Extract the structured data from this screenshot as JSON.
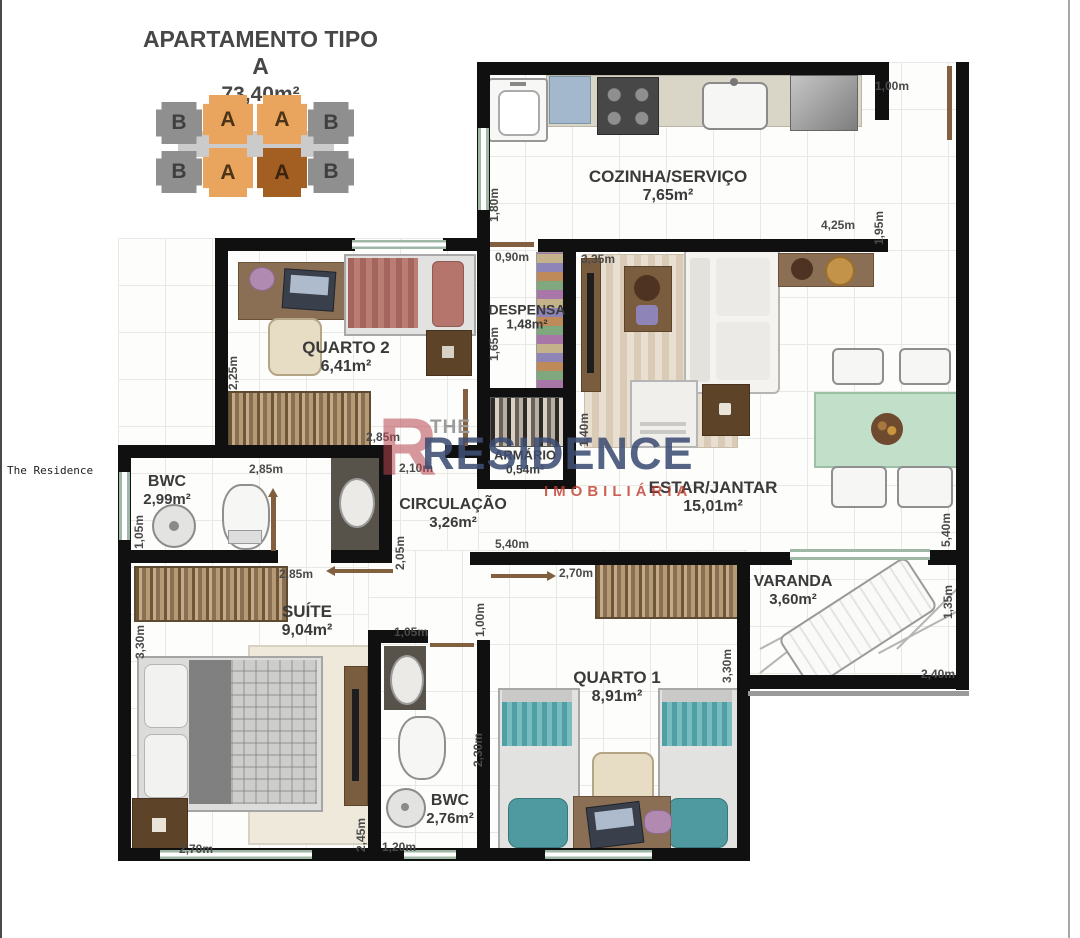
{
  "header": {
    "title": "APARTAMENTO TIPO A",
    "area": "73,40m²"
  },
  "side_text": "The Residence",
  "watermark": {
    "the": "THE",
    "big_letter": "R",
    "main": "RESIDENCE",
    "sub": "IMOBILIÁRIA"
  },
  "key_plan": {
    "units": [
      {
        "label": "B"
      },
      {
        "label": "A"
      },
      {
        "label": "A"
      },
      {
        "label": "B"
      },
      {
        "label": "B"
      },
      {
        "label": "A"
      },
      {
        "label": "A",
        "highlighted": true
      },
      {
        "label": "B"
      }
    ],
    "highlighted_index": 6
  },
  "colors": {
    "wall": "#101010",
    "window": "#9fb7a5",
    "unit_a": "#e9a55e",
    "unit_a_highlighted": "#a35f22",
    "unit_b": "#8f8f8f",
    "watermark_navy": "#3d4d73",
    "watermark_red": "#c0392b",
    "label_gray": "#3a3a3a"
  },
  "rooms": [
    {
      "id": "cozinha",
      "name": "COZINHA/SERVIÇO",
      "area": "7,65m²",
      "x": 668,
      "y": 186,
      "fs": 17
    },
    {
      "id": "despensa",
      "name": "DESPENSA",
      "area": "1,48m²",
      "x": 527,
      "y": 317,
      "fs": 14
    },
    {
      "id": "quarto-2",
      "name": "QUARTO 2",
      "area": "6,41m²",
      "x": 346,
      "y": 357,
      "fs": 17
    },
    {
      "id": "armario",
      "name": "ARMÁRIO",
      "area": "0,54m²",
      "x": 525,
      "y": 463,
      "fs": 13
    },
    {
      "id": "estar-jantar",
      "name": "ESTAR/JANTAR",
      "area": "15,01m²",
      "x": 713,
      "y": 497,
      "fs": 17
    },
    {
      "id": "circulacao",
      "name": "CIRCULAÇÃO",
      "area": "3,26m²",
      "x": 453,
      "y": 514,
      "fs": 16
    },
    {
      "id": "bwc-suite",
      "name": "BWC",
      "area": "2,99m²",
      "x": 167,
      "y": 491,
      "fs": 16
    },
    {
      "id": "suite",
      "name": "SUÍTE",
      "area": "9,04m²",
      "x": 307,
      "y": 621,
      "fs": 17
    },
    {
      "id": "varanda",
      "name": "VARANDA",
      "area": "3,60m²",
      "x": 793,
      "y": 591,
      "fs": 16
    },
    {
      "id": "quarto-1",
      "name": "QUARTO 1",
      "area": "8,91m²",
      "x": 617,
      "y": 687,
      "fs": 17
    },
    {
      "id": "bwc-social",
      "name": "BWC",
      "area": "2,76m²",
      "x": 450,
      "y": 810,
      "fs": 16
    }
  ],
  "dimensions": [
    {
      "text": "1,00m",
      "x": 892,
      "y": 86,
      "rot": 0
    },
    {
      "text": "1,80m",
      "x": 494,
      "y": 205,
      "rot": -90
    },
    {
      "text": "0,90m",
      "x": 512,
      "y": 257,
      "rot": 0
    },
    {
      "text": "3,35m",
      "x": 598,
      "y": 259,
      "rot": 0
    },
    {
      "text": "4,25m",
      "x": 838,
      "y": 225,
      "rot": 0
    },
    {
      "text": "1,95m",
      "x": 879,
      "y": 228,
      "rot": -90
    },
    {
      "text": "2,25m",
      "x": 233,
      "y": 373,
      "rot": -90
    },
    {
      "text": "2,85m",
      "x": 383,
      "y": 437,
      "rot": 0
    },
    {
      "text": "1,65m",
      "x": 494,
      "y": 344,
      "rot": -90
    },
    {
      "text": "1,40m",
      "x": 584,
      "y": 430,
      "rot": -90
    },
    {
      "text": "2,85m",
      "x": 266,
      "y": 469,
      "rot": 0
    },
    {
      "text": "2,10m",
      "x": 416,
      "y": 468,
      "rot": 0
    },
    {
      "text": "2,05m",
      "x": 400,
      "y": 553,
      "rot": -90
    },
    {
      "text": "1,05m",
      "x": 139,
      "y": 532,
      "rot": -90
    },
    {
      "text": "2,85m",
      "x": 296,
      "y": 574,
      "rot": 0
    },
    {
      "text": "5,40m",
      "x": 512,
      "y": 544,
      "rot": 0
    },
    {
      "text": "2,70m",
      "x": 576,
      "y": 573,
      "rot": 0
    },
    {
      "text": "5,40m",
      "x": 946,
      "y": 530,
      "rot": -90
    },
    {
      "text": "1,35m",
      "x": 948,
      "y": 602,
      "rot": -90
    },
    {
      "text": "2,40m",
      "x": 938,
      "y": 674,
      "rot": 0
    },
    {
      "text": "3,30m",
      "x": 140,
      "y": 642,
      "rot": -90
    },
    {
      "text": "1,00m",
      "x": 480,
      "y": 620,
      "rot": -90
    },
    {
      "text": "2,30m",
      "x": 478,
      "y": 750,
      "rot": -90
    },
    {
      "text": "3,30m",
      "x": 727,
      "y": 666,
      "rot": -90
    },
    {
      "text": "2,45m",
      "x": 361,
      "y": 835,
      "rot": -90
    },
    {
      "text": "2,70m",
      "x": 196,
      "y": 849,
      "rot": 0
    },
    {
      "text": "1,20m",
      "x": 399,
      "y": 847,
      "rot": 0
    },
    {
      "text": "1,05m",
      "x": 411,
      "y": 632,
      "rot": 0
    }
  ]
}
